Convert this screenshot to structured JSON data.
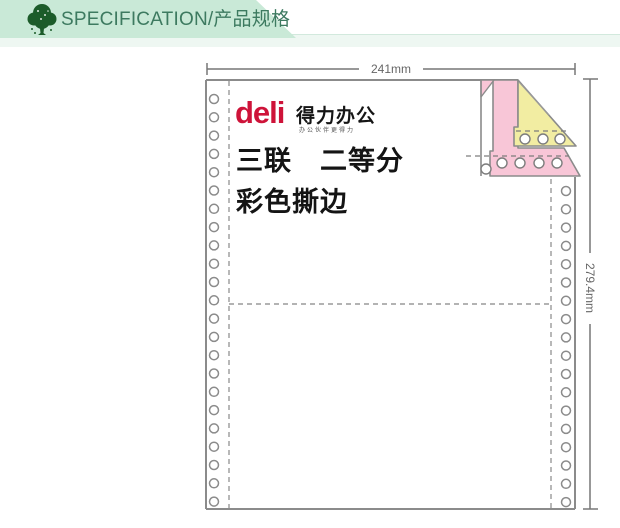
{
  "header": {
    "title": "SPECIFICATION/产品规格",
    "icon": "tree-icon",
    "banner_color": "#c9e9d7",
    "title_color": "#3d7a60"
  },
  "diagram": {
    "width_label": "241mm",
    "height_label": "279.4mm",
    "logo": {
      "brand": "deli",
      "brand_cn": "得力办公",
      "tagline": "办公伙伴更得力",
      "brand_color": "#ce1339"
    },
    "spec_line1": "三联　二等分",
    "spec_line2": "彩色撕边",
    "colors": {
      "sheet_white": "#ffffff",
      "sheet_yellow": "#f2eda2",
      "sheet_pink": "#f8c6d7",
      "outline": "#8b8b8b"
    },
    "feed_holes": {
      "left": {
        "x": 214,
        "y_start": 99,
        "step": 18.3,
        "count": 23
      },
      "right": {
        "x": 566,
        "y_start": 191,
        "step": 18.3,
        "count": 18
      }
    }
  }
}
